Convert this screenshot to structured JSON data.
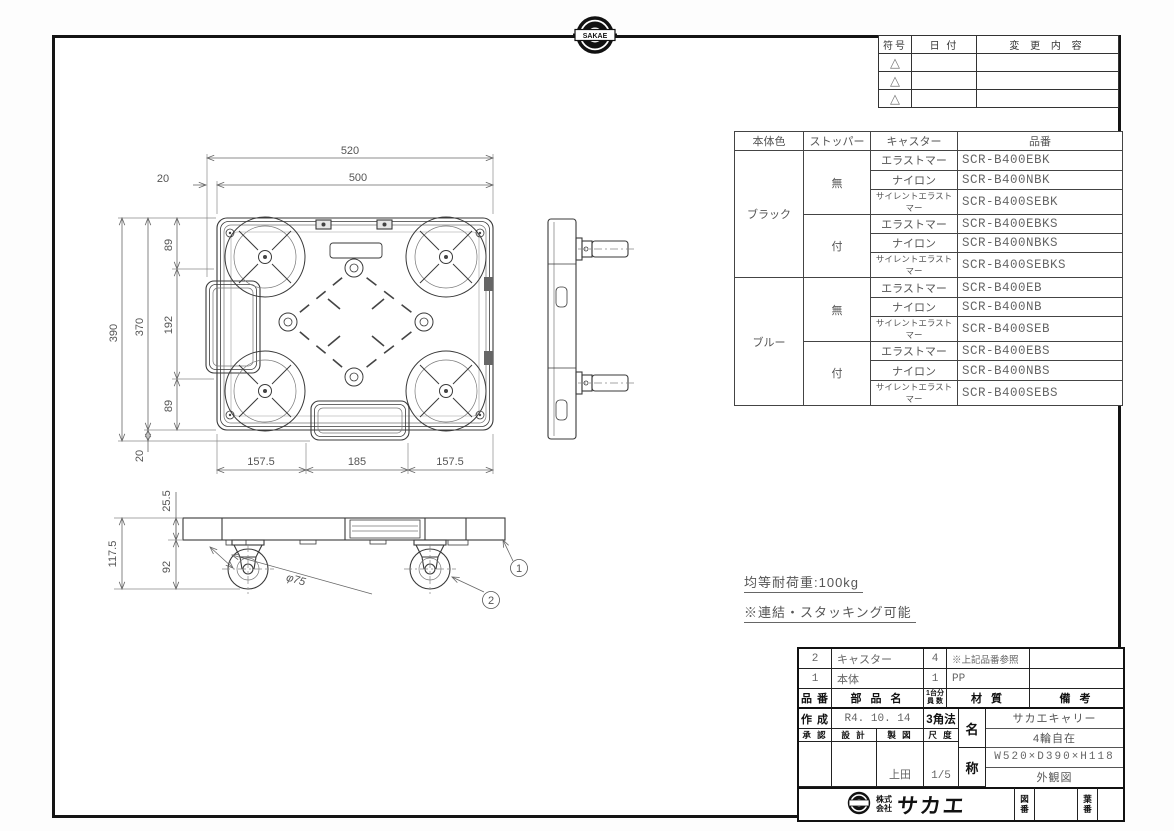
{
  "page": {
    "top_logo_text": "SAKAE"
  },
  "revision_table": {
    "headers": {
      "symbol": "符号",
      "date": "日 付",
      "content": "変 更 内 容"
    },
    "symbol_glyph": "△"
  },
  "product_table": {
    "headers": [
      "本体色",
      "ストッパー",
      "キャスター",
      "品番"
    ],
    "colors": [
      {
        "label": "ブラック",
        "stoppers": [
          {
            "label": "無",
            "rows": [
              [
                "エラストマー",
                "SCR-B400EBK"
              ],
              [
                "ナイロン",
                "SCR-B400NBK"
              ],
              [
                "サイレントエラストマー",
                "SCR-B400SEBK"
              ]
            ]
          },
          {
            "label": "付",
            "rows": [
              [
                "エラストマー",
                "SCR-B400EBKS"
              ],
              [
                "ナイロン",
                "SCR-B400NBKS"
              ],
              [
                "サイレントエラストマー",
                "SCR-B400SEBKS"
              ]
            ]
          }
        ]
      },
      {
        "label": "ブルー",
        "stoppers": [
          {
            "label": "無",
            "rows": [
              [
                "エラストマー",
                "SCR-B400EB"
              ],
              [
                "ナイロン",
                "SCR-B400NB"
              ],
              [
                "サイレントエラストマー",
                "SCR-B400SEB"
              ]
            ]
          },
          {
            "label": "付",
            "rows": [
              [
                "エラストマー",
                "SCR-B400EBS"
              ],
              [
                "ナイロン",
                "SCR-B400NBS"
              ],
              [
                "サイレントエラストマー",
                "SCR-B400SEBS"
              ]
            ]
          }
        ]
      }
    ]
  },
  "drawing": {
    "plan": {
      "dim_overall_w": "520",
      "dim_inner_w": "500",
      "dim_offset_left": "20",
      "dim_top_89": "89",
      "dim_mid_192": "192",
      "dim_bot_89": "89",
      "dim_overall_h": "390",
      "dim_inner_h": "370",
      "dim_offset_bottom": "20",
      "dim_b_left": "157.5",
      "dim_b_mid": "185",
      "dim_b_right": "157.5"
    },
    "front": {
      "dim_body_h": "25.5",
      "dim_total_h": "117.5",
      "dim_caster_h": "92",
      "caster_dia": "φ75",
      "balloon_1": "1",
      "balloon_2": "2"
    }
  },
  "notes": {
    "load": "均等耐荷重:100kg",
    "stacking": "※連結・スタッキング可能"
  },
  "title_block": {
    "parts": [
      {
        "no": "2",
        "name": "キャスター",
        "qty": "4",
        "material": "※上記品番参照",
        "remarks": ""
      },
      {
        "no": "1",
        "name": "本体",
        "qty": "1",
        "material": "PP",
        "remarks": ""
      }
    ],
    "headers": {
      "no": "品 番",
      "name": "部 品 名",
      "qty_line1": "1台分",
      "qty_line2": "員 数",
      "material": "材  質",
      "remarks": "備  考"
    },
    "created_label": "作 成",
    "created_date": "R4. 10. 14",
    "projection": "3角法",
    "approve_label": "承 認",
    "design_label": "設 計",
    "draft_label": "製 図",
    "scale_label": "尺 度",
    "draft_value": "上田",
    "scale_value": "1/5",
    "name_label_top": "名",
    "name_label_bottom": "称",
    "product_names": [
      "サカエキャリー",
      "4輪自在",
      "W520×D390×H118",
      "外観図"
    ],
    "company_prefix_line1": "株式",
    "company_prefix_line2": "会社",
    "company_name": "サカエ",
    "drawing_no_top": "図",
    "drawing_no_bottom": "番",
    "sheet_no_top": "葉",
    "sheet_no_bottom": "番"
  }
}
